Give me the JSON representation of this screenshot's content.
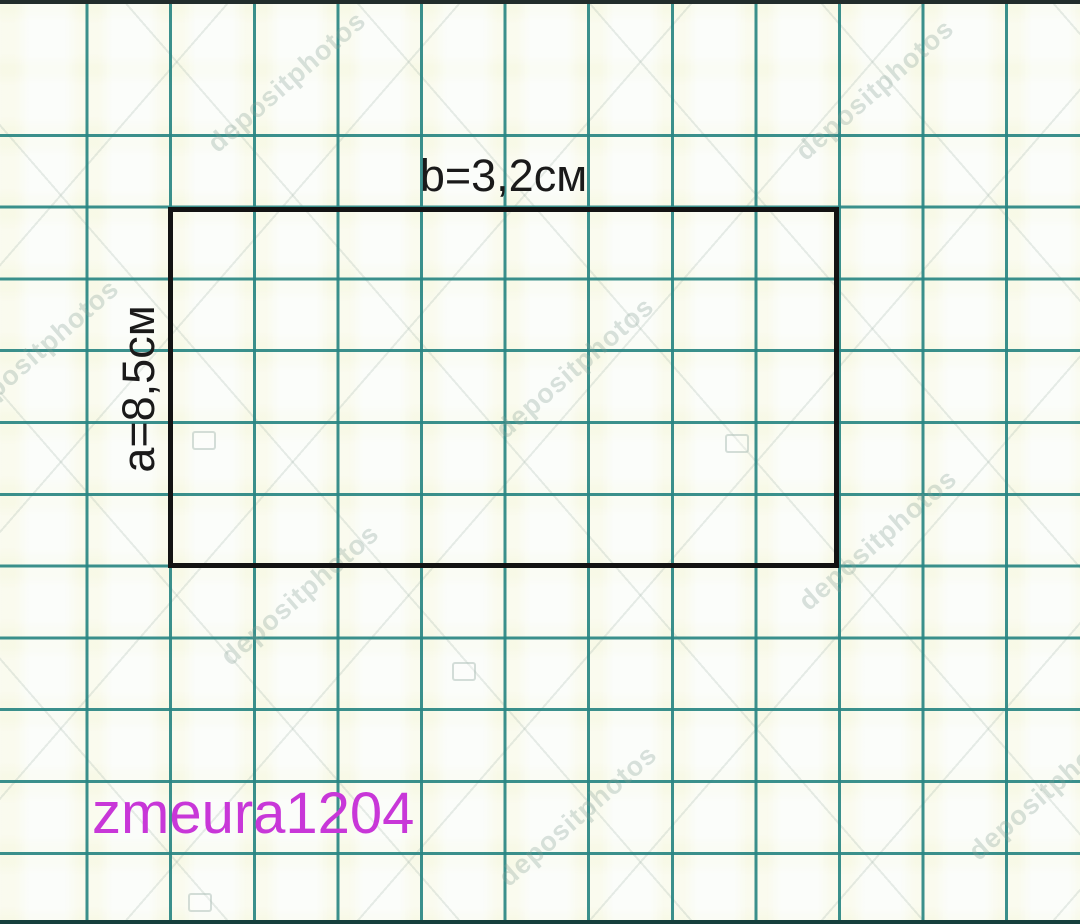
{
  "figure": {
    "top_label": "b=3,2см",
    "side_label": "a=8,5см"
  },
  "watermarks": {
    "username": "zmeura1204",
    "stock_text": "depositphotos"
  },
  "colors": {
    "grid_line": "#2a8683",
    "paper_background": "#eef6e8",
    "rectangle_border": "#131313",
    "label_text": "#1a1a1a",
    "username_watermark": "#c837d8"
  }
}
